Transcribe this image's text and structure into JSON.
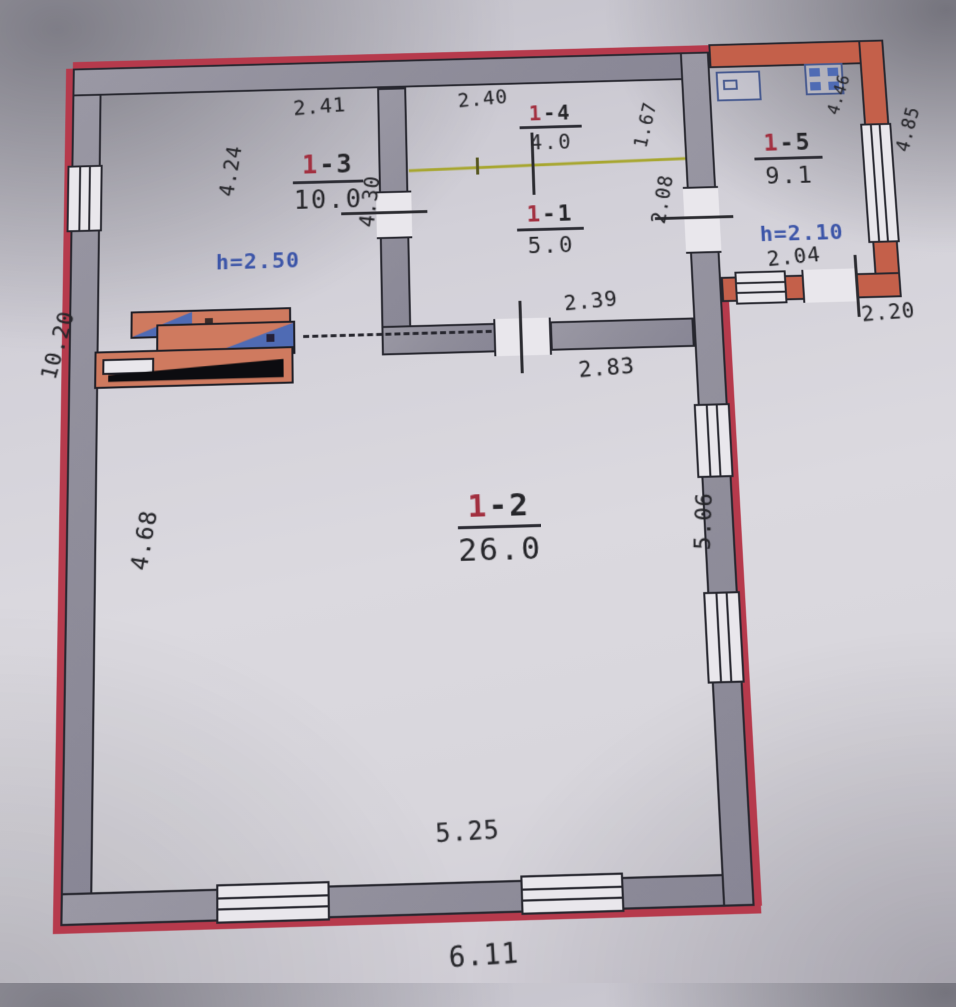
{
  "rooms": {
    "r13": {
      "num": "1",
      "suffix": "-3",
      "area": "10.0",
      "height": "h=2.50"
    },
    "r14": {
      "num": "1",
      "suffix": "-4",
      "area": "4.0"
    },
    "r11": {
      "num": "1",
      "suffix": "-1",
      "area": "5.0"
    },
    "r15": {
      "num": "1",
      "suffix": "-5",
      "area": "9.1",
      "height": "h=2.10"
    },
    "r12": {
      "num": "1",
      "suffix": "-2",
      "area": "26.0"
    }
  },
  "dims": {
    "top_1_3": "2.41",
    "left_1_3": "4.24",
    "right_1_3": "4.30",
    "top_1_4": "2.40",
    "right_1_4": "1.67",
    "right_1_1": "2.08",
    "bottom_1_1": "2.39",
    "opening_1_2": "2.83",
    "inner_1_5": "4.46",
    "outer_right_1_5": "4.85",
    "bottom_inner_1_5": "2.04",
    "bottom_outer_1_5": "2.20",
    "outer_left": "10.20",
    "left_1_2": "4.68",
    "right_1_2": "5.06",
    "bottom_inner_1_2": "5.25",
    "bottom_outer": "6.11"
  },
  "colors": {
    "paper": "#d7d5db",
    "wall_fill": "#8f8d9a",
    "wall_outline": "#26262e",
    "outer_edge_red": "#b63a4c",
    "annex_wall_red": "#c4604a",
    "stove_salmon": "#cf7a5f",
    "stove_blue": "#4f6bb4",
    "partition_line_yellow": "#a7a62f",
    "room_number_red": "#a23040",
    "height_label_blue": "#3c55a8"
  },
  "icons": {
    "annex_fixture_left": "washbasin-icon",
    "annex_fixture_right": "cooker-icon",
    "stove": "stove-furnace-symbol"
  }
}
